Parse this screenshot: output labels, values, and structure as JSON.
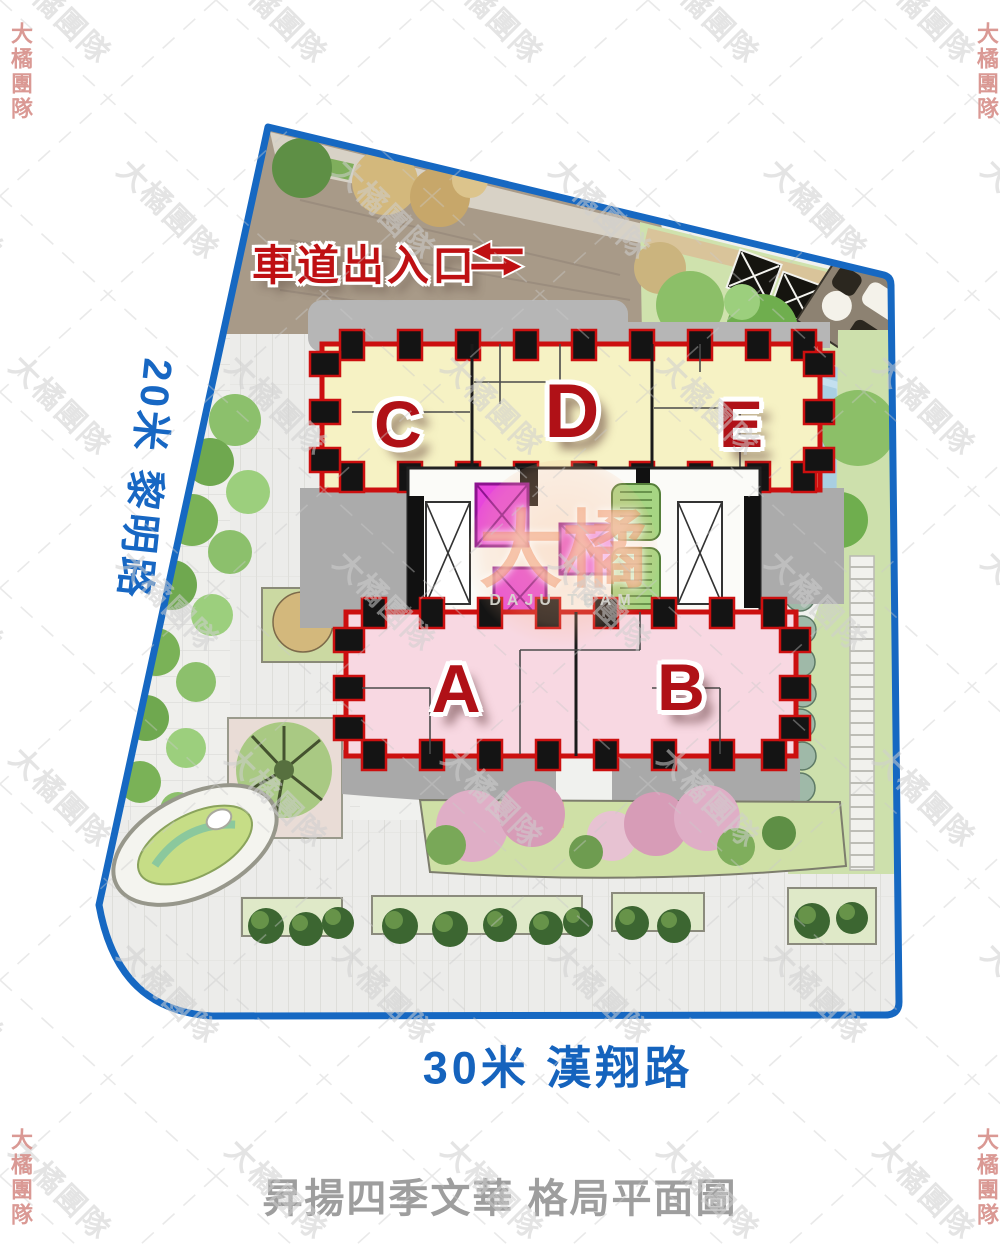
{
  "plan": {
    "driveway_label": "車道出入口",
    "roads": {
      "left": "20米 黎明路",
      "bottom": "30米 漢翔路"
    },
    "title": "昇揚四季文華 格局平面圖",
    "units": [
      {
        "label": "C"
      },
      {
        "label": "D"
      },
      {
        "label": "E"
      },
      {
        "label": "A"
      },
      {
        "label": "B"
      }
    ]
  },
  "watermark": {
    "tile_text": "大橘團隊",
    "center_text": "大橘",
    "center_subtext": "DAJU TEAM"
  },
  "colors": {
    "boundary_blue": "#1668c2",
    "road_text_blue": "#1563bd",
    "unit_letter_red": "#b01117",
    "driveway_text_red": "#bf1013",
    "building_outline_red": "#cc0f0f",
    "upper_block_yellow": "#f6f2c4",
    "lower_block_pink": "#f8d8e2",
    "elevator_magenta": "#e746dc",
    "stair_green": "#a6d583",
    "driveway_taupe": "#a89a88",
    "plaza_gray": "#efefec",
    "title_gray": "#9e9e9e"
  }
}
